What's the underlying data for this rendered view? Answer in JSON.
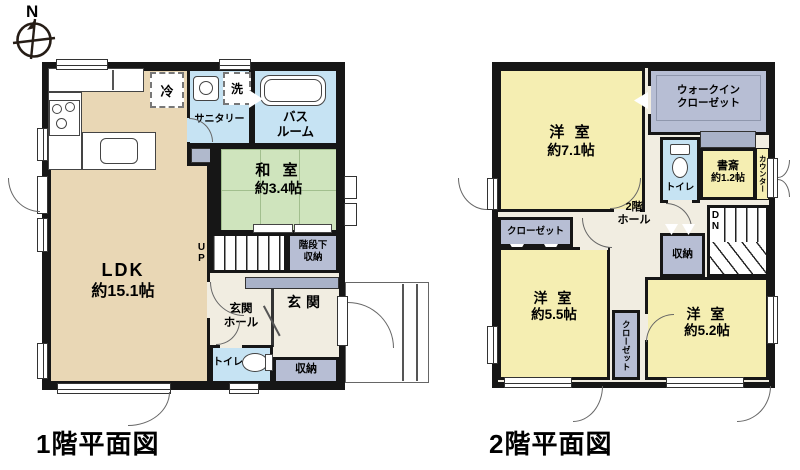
{
  "colors": {
    "wall": "#161616",
    "ldk": "#e9d7b5",
    "tatami": "#cfe4bd",
    "tatami_line": "#a2bf8e",
    "water": "#c6e3f3",
    "bedroom": "#f5eeb2",
    "closet": "#b7bed4",
    "cabinet": "#a9b2c8",
    "hall": "#f1ede1"
  },
  "compass": {
    "label": "N"
  },
  "floor1": {
    "title": "1階平面図",
    "ldk": {
      "name": "LDK",
      "size": "約15.1帖"
    },
    "washitsu": {
      "name": "和 室",
      "size": "約3.4帖"
    },
    "sanitary": "サニタリー",
    "bath_l1": "バス",
    "bath_l2": "ルーム",
    "fridge": "冷",
    "washer": "洗",
    "stairs": "UP",
    "understair_l1": "階段下",
    "understair_l2": "収納",
    "hall_l1": "玄関",
    "hall_l2": "ホール",
    "genkan": "玄関",
    "toilet": "トイレ",
    "storage": "収納"
  },
  "floor2": {
    "title": "2階平面図",
    "bedroom71": {
      "name": "洋 室",
      "size": "約7.1帖"
    },
    "bedroom55": {
      "name": "洋 室",
      "size": "約5.5帖"
    },
    "bedroom52": {
      "name": "洋 室",
      "size": "約5.2帖"
    },
    "wic_l1": "ウォークイン",
    "wic_l2": "クローゼット",
    "toilet": "トイレ",
    "study": {
      "name": "書斎",
      "size": "約1.2帖"
    },
    "counter": "カウンター",
    "hall_l1": "2階",
    "hall_l2": "ホール",
    "stairs": "DN",
    "storage": "収納",
    "closet_h": "クローゼット",
    "closet_v": "クローゼット"
  }
}
